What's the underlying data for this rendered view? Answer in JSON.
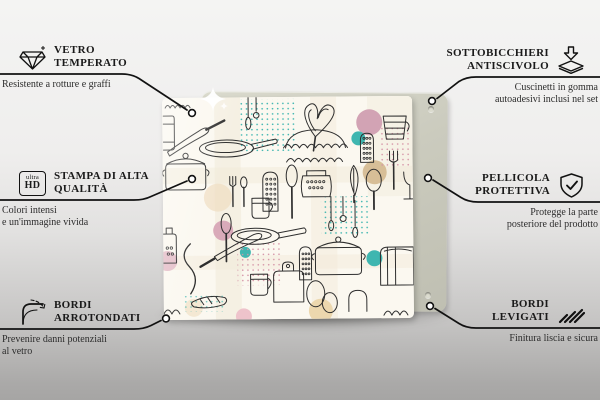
{
  "panel": {
    "pattern": "kitchen-utensils-doodle-print",
    "palette": {
      "doodle_line": "#2e2e2e",
      "teal": "#3fb6b0",
      "pink": "#d2a3b4",
      "tan": "#cfb284",
      "peach": "#ecd7ae",
      "backing": "#c9c9bd"
    }
  },
  "features": {
    "top_left": {
      "icon": "diamond-icon",
      "title_lines": [
        "VETRO",
        "TEMPERATO"
      ],
      "desc_lines": [
        "Resistente a rotture e graffi"
      ]
    },
    "mid_left": {
      "icon": "ultra-hd-icon",
      "icon_text_top": "ultra",
      "icon_text_bottom": "HD",
      "title_lines": [
        "STAMPA DI ALTA",
        "QUALITÀ"
      ],
      "desc_lines": [
        "Colori intensi",
        "e un'immagine vivida"
      ]
    },
    "bottom_left": {
      "icon": "rounded-corner-icon",
      "title_lines": [
        "BORDI",
        "ARROTONDATI"
      ],
      "desc_lines": [
        "Prevenire danni potenziali",
        "al vetro"
      ]
    },
    "top_right": {
      "icon": "anti-slip-pad-icon",
      "title_lines": [
        "SOTTOBICCHIERI",
        "ANTISCIVOLO"
      ],
      "desc_lines": [
        "Cuscinetti in gomma",
        "autoadesivi inclusi nel set"
      ]
    },
    "mid_right": {
      "icon": "shield-check-icon",
      "title_lines": [
        "PELLICOLA",
        "PROTETTIVA"
      ],
      "desc_lines": [
        "Protegge la parte",
        "posteriore del prodotto"
      ]
    },
    "bottom_right": {
      "icon": "polished-edge-icon",
      "title_lines": [
        "BORDI",
        "LEVIGATI"
      ],
      "desc_lines": [
        "Finitura liscia e sicura"
      ]
    }
  }
}
